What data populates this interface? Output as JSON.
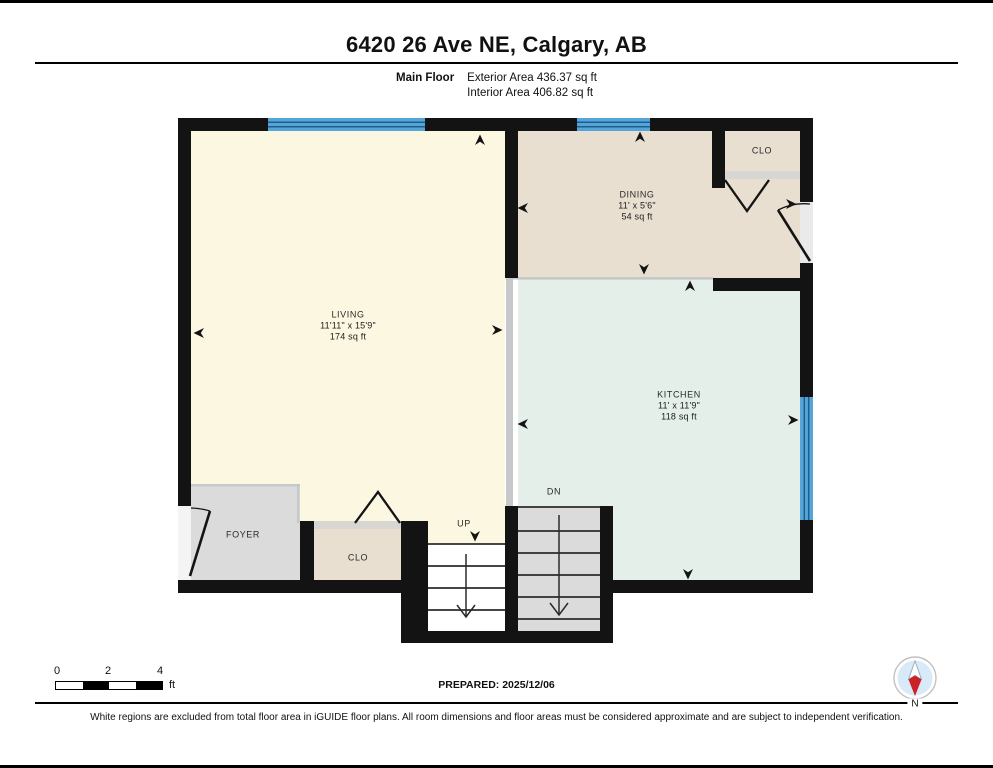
{
  "page": {
    "title": "6420 26 Ave NE, Calgary, AB",
    "floor_label": "Main Floor",
    "exterior_area": "Exterior Area 436.37 sq ft",
    "interior_area": "Interior Area 406.82 sq ft"
  },
  "rooms": {
    "living": {
      "name": "LIVING",
      "dims": "11'11\" x 15'9\"",
      "area": "174 sq ft"
    },
    "dining": {
      "name": "DINING",
      "dims": "11' x 5'6\"",
      "area": "54 sq ft"
    },
    "kitchen": {
      "name": "KITCHEN",
      "dims": "11' x 11'9\"",
      "area": "118 sq ft"
    },
    "foyer": {
      "name": "FOYER"
    },
    "closet_main": {
      "name": "CLO"
    },
    "closet_dining": {
      "name": "CLO"
    },
    "stairs_up": {
      "name": "UP"
    },
    "stairs_down": {
      "name": "DN"
    }
  },
  "scale_bar": {
    "ticks": [
      "0",
      "2",
      "4"
    ],
    "unit": "ft"
  },
  "footer": {
    "prepared": "PREPARED: 2025/12/06",
    "disclaimer": "White regions are excluded from total floor area in iGUIDE floor plans. All room dimensions and floor areas must be considered approximate and are subject to independent verification."
  },
  "compass": {
    "label": "N"
  },
  "colors": {
    "wall": "#131313",
    "living": "#FCF7E1",
    "dining": "#E8DFD0",
    "kitchen": "#E4EFE9",
    "foyer": "#DBDBDB",
    "stairs_dn": "#DBDBDB",
    "closet": "#E8DFD0",
    "window": "#55A5D9",
    "window_line": "#1F5E8C",
    "compass_fill": "#D8E9F7",
    "compass_north": "#CC2127"
  }
}
